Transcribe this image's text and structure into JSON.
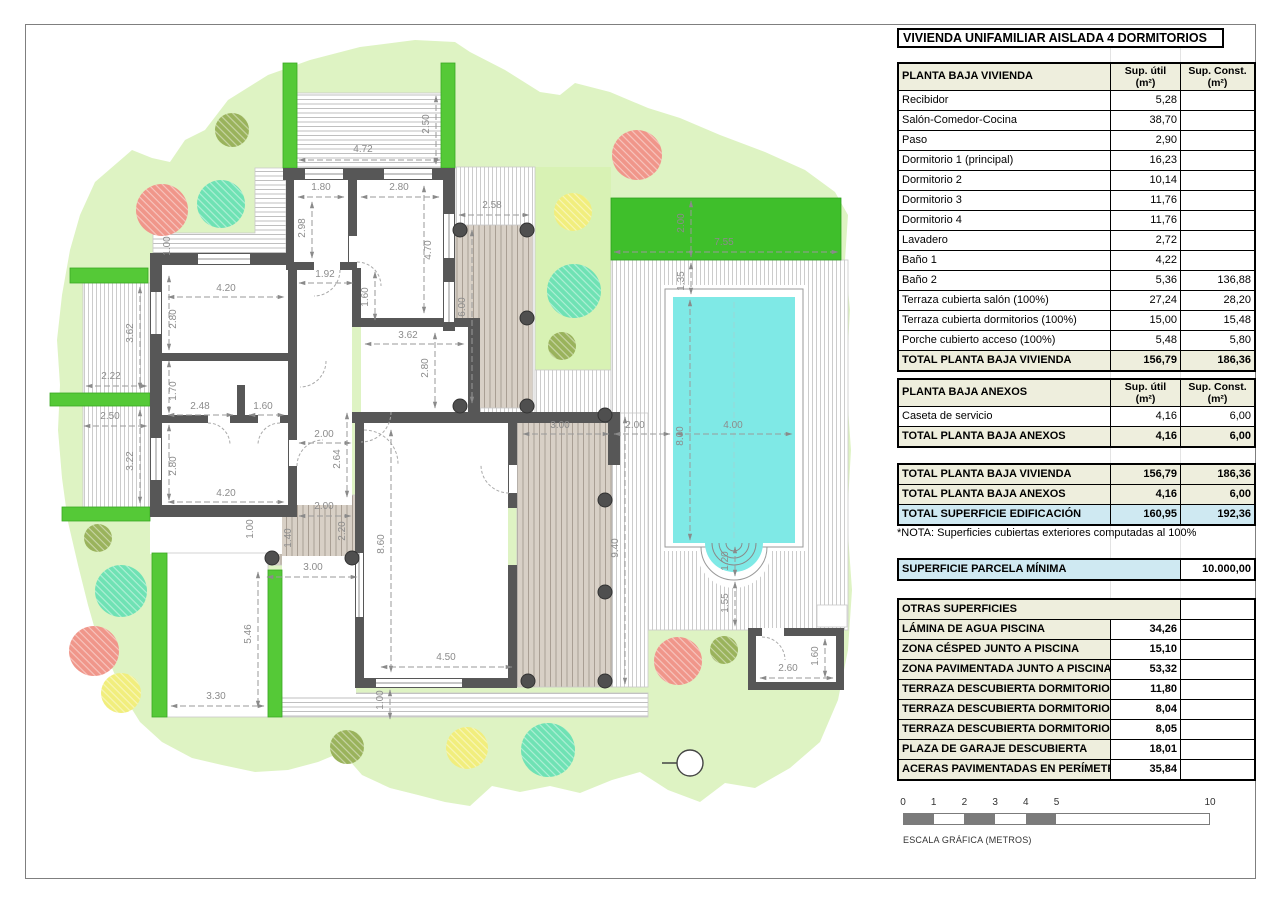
{
  "title": "VIVIENDA UNIFAMILIAR AISLADA 4 DORMITORIOS",
  "tables": {
    "vivienda": {
      "title": "PLANTA BAJA VIVIENDA",
      "col1": "Sup. útil",
      "col2": "Sup. Const.",
      "unit": "(m²)",
      "rows": [
        [
          "Recibidor",
          "5,28",
          ""
        ],
        [
          "Salón-Comedor-Cocina",
          "38,70",
          ""
        ],
        [
          "Paso",
          "2,90",
          ""
        ],
        [
          "Dormitorio 1 (principal)",
          "16,23",
          ""
        ],
        [
          "Dormitorio 2",
          "10,14",
          ""
        ],
        [
          "Dormitorio 3",
          "11,76",
          ""
        ],
        [
          "Dormitorio 4",
          "11,76",
          ""
        ],
        [
          "Lavadero",
          "2,72",
          ""
        ],
        [
          "Baño 1",
          "4,22",
          ""
        ],
        [
          "Baño 2",
          "5,36",
          "136,88"
        ],
        [
          "Terraza cubierta salón (100%)",
          "27,24",
          "28,20"
        ],
        [
          "Terraza cubierta dormitorios (100%)",
          "15,00",
          "15,48"
        ],
        [
          "Porche cubierto acceso (100%)",
          "5,48",
          "5,80"
        ]
      ],
      "total": [
        "TOTAL PLANTA BAJA VIVIENDA",
        "156,79",
        "186,36"
      ]
    },
    "anexos": {
      "title": "PLANTA BAJA ANEXOS",
      "col1": "Sup. útil",
      "col2": "Sup. Const.",
      "unit": "(m²)",
      "rows": [
        [
          "Caseta de servicio",
          "4,16",
          "6,00"
        ]
      ],
      "total": [
        "TOTAL PLANTA BAJA ANEXOS",
        "4,16",
        "6,00"
      ]
    },
    "totales": {
      "rows": [
        [
          "TOTAL PLANTA BAJA VIVIENDA",
          "156,79",
          "186,36",
          false
        ],
        [
          "TOTAL PLANTA BAJA ANEXOS",
          "4,16",
          "6,00",
          false
        ],
        [
          "TOTAL SUPERFICIE EDIFICACIÓN",
          "160,95",
          "192,36",
          true
        ]
      ]
    },
    "parcela": [
      "SUPERFICIE PARCELA MÍNIMA",
      "10.000,00"
    ],
    "otras": {
      "title": "OTRAS SUPERFICIES",
      "rows": [
        [
          "LÁMINA DE AGUA PISCINA",
          "34,26"
        ],
        [
          "ZONA CÉSPED JUNTO A PISCINA",
          "15,10"
        ],
        [
          "ZONA PAVIMENTADA JUNTO A PISCINA",
          "53,32"
        ],
        [
          "TERRAZA DESCUBIERTA DORMITORIO 1",
          "11,80"
        ],
        [
          "TERRAZA DESCUBIERTA DORMITORIO 3",
          "8,04"
        ],
        [
          "TERRAZA DESCUBIERTA DORMITORIO 4",
          "8,05"
        ],
        [
          "PLAZA DE GARAJE DESCUBIERTA",
          "18,01"
        ],
        [
          "ACERAS PAVIMENTADAS EN PERÍMETRO",
          "35,84"
        ]
      ]
    }
  },
  "nota": "*NOTA: Superficies cubiertas exteriores computadas al 100%",
  "scalebar": {
    "ticks": [
      {
        "v": "0",
        "m": 0
      },
      {
        "v": "1",
        "m": 1
      },
      {
        "v": "2",
        "m": 2
      },
      {
        "v": "3",
        "m": 3
      },
      {
        "v": "4",
        "m": 4
      },
      {
        "v": "5",
        "m": 5
      },
      {
        "v": "10",
        "m": 10
      }
    ],
    "segments": [
      [
        0,
        1
      ],
      [
        2,
        3
      ],
      [
        4,
        5
      ]
    ],
    "meters_total": 10,
    "label": "ESCALA GRÁFICA (METROS)"
  },
  "plan": {
    "colors": {
      "garden": "#def3c3",
      "lawn": "#d8f2b4",
      "hedge": "#55c937",
      "cesped": "#3fbf2b",
      "wall": "#575757",
      "water": "#7fe9e6",
      "beige": "#d8d0c6",
      "red": "#f0968a",
      "teal": "#6fe2b4",
      "yellow": "#f1ee7d",
      "olive": "#9ab35c"
    },
    "hedges": [
      [
        283,
        63,
        14,
        105
      ],
      [
        441,
        63,
        14,
        105
      ],
      [
        70,
        268,
        78,
        15
      ],
      [
        50,
        393,
        100,
        13
      ],
      [
        62,
        507,
        88,
        14
      ],
      [
        152,
        553,
        15,
        164
      ],
      [
        268,
        570,
        14,
        147
      ]
    ],
    "columns": [
      [
        460,
        230
      ],
      [
        527,
        230
      ],
      [
        527,
        318
      ],
      [
        460,
        406
      ],
      [
        527,
        406
      ],
      [
        605,
        415
      ],
      [
        605,
        500
      ],
      [
        605,
        592
      ],
      [
        528,
        681
      ],
      [
        605,
        681
      ],
      [
        272,
        558
      ],
      [
        352,
        558
      ]
    ],
    "trees": [
      {
        "x": 232,
        "y": 130,
        "r": 17,
        "c": "olive"
      },
      {
        "x": 162,
        "y": 210,
        "r": 26,
        "c": "red"
      },
      {
        "x": 221,
        "y": 204,
        "r": 24,
        "c": "teal"
      },
      {
        "x": 637,
        "y": 155,
        "r": 25,
        "c": "red"
      },
      {
        "x": 573,
        "y": 212,
        "r": 19,
        "c": "yellow"
      },
      {
        "x": 574,
        "y": 291,
        "r": 27,
        "c": "teal"
      },
      {
        "x": 562,
        "y": 346,
        "r": 14,
        "c": "olive"
      },
      {
        "x": 98,
        "y": 538,
        "r": 14,
        "c": "olive"
      },
      {
        "x": 121,
        "y": 591,
        "r": 26,
        "c": "teal"
      },
      {
        "x": 94,
        "y": 651,
        "r": 25,
        "c": "red"
      },
      {
        "x": 121,
        "y": 693,
        "r": 20,
        "c": "yellow"
      },
      {
        "x": 347,
        "y": 747,
        "r": 17,
        "c": "olive"
      },
      {
        "x": 467,
        "y": 748,
        "r": 21,
        "c": "yellow"
      },
      {
        "x": 548,
        "y": 750,
        "r": 27,
        "c": "teal"
      },
      {
        "x": 678,
        "y": 661,
        "r": 24,
        "c": "red"
      },
      {
        "x": 724,
        "y": 650,
        "r": 14,
        "c": "olive"
      }
    ],
    "dims": [
      {
        "t": "4.72",
        "x": 363,
        "y": 152,
        "r": 0,
        "l": [
          299,
          160,
          440,
          160
        ]
      },
      {
        "t": "2.50",
        "x": 429,
        "y": 124,
        "r": 90,
        "l": [
          436,
          96,
          436,
          164
        ]
      },
      {
        "t": "1.80",
        "x": 321,
        "y": 190,
        "r": 0,
        "l": [
          298,
          197,
          344,
          197
        ]
      },
      {
        "t": "2.80",
        "x": 399,
        "y": 190,
        "r": 0,
        "l": [
          361,
          197,
          439,
          197
        ]
      },
      {
        "t": "2.98",
        "x": 305,
        "y": 228,
        "r": 90,
        "l": [
          312,
          202,
          312,
          258
        ]
      },
      {
        "t": "4.70",
        "x": 431,
        "y": 250,
        "r": 90,
        "l": [
          424,
          186,
          424,
          313
        ]
      },
      {
        "t": "2.58",
        "x": 492,
        "y": 208,
        "r": 0,
        "l": [
          459,
          215,
          529,
          215
        ]
      },
      {
        "t": "1.92",
        "x": 325,
        "y": 277,
        "r": 0,
        "l": [
          299,
          283,
          353,
          283
        ]
      },
      {
        "t": "1.60",
        "x": 368,
        "y": 297,
        "r": 90,
        "l": [
          375,
          272,
          375,
          320
        ]
      },
      {
        "t": "4.20",
        "x": 226,
        "y": 291,
        "r": 0,
        "l": [
          168,
          297,
          284,
          297
        ]
      },
      {
        "t": "2.80",
        "x": 176,
        "y": 319,
        "r": 90,
        "l": [
          169,
          276,
          169,
          350
        ]
      },
      {
        "t": "3.62",
        "x": 408,
        "y": 338,
        "r": 0,
        "l": [
          365,
          344,
          464,
          344
        ]
      },
      {
        "t": "2.80",
        "x": 428,
        "y": 368,
        "r": 90,
        "l": [
          435,
          333,
          435,
          408
        ]
      },
      {
        "t": "3.62",
        "x": 133,
        "y": 333,
        "r": 90,
        "l": [
          140,
          287,
          140,
          389
        ]
      },
      {
        "t": "2.22",
        "x": 111,
        "y": 379,
        "r": 0,
        "l": [
          86,
          386,
          147,
          386
        ]
      },
      {
        "t": "2.50",
        "x": 110,
        "y": 419,
        "r": 0,
        "l": [
          84,
          426,
          147,
          426
        ]
      },
      {
        "t": "3.22",
        "x": 133,
        "y": 461,
        "r": 90,
        "l": [
          140,
          410,
          140,
          503
        ]
      },
      {
        "t": "1.70",
        "x": 176,
        "y": 391,
        "r": 90,
        "l": [
          169,
          361,
          169,
          413
        ]
      },
      {
        "t": "2.48",
        "x": 200,
        "y": 409,
        "r": 0,
        "l": [
          168,
          415,
          233,
          415
        ]
      },
      {
        "t": "1.60",
        "x": 263,
        "y": 409,
        "r": 0,
        "l": [
          249,
          415,
          284,
          415
        ]
      },
      {
        "t": "2.80",
        "x": 176,
        "y": 466,
        "r": 90,
        "l": [
          169,
          425,
          169,
          500
        ]
      },
      {
        "t": "4.20",
        "x": 226,
        "y": 496,
        "r": 0,
        "l": [
          168,
          502,
          284,
          502
        ]
      },
      {
        "t": "2.00",
        "x": 324,
        "y": 437,
        "r": 0,
        "l": [
          299,
          443,
          351,
          443
        ]
      },
      {
        "t": "2.64",
        "x": 340,
        "y": 459,
        "r": 90,
        "l": [
          347,
          413,
          347,
          497
        ]
      },
      {
        "t": "2.00",
        "x": 324,
        "y": 509,
        "r": 0,
        "l": [
          299,
          516,
          351,
          516
        ]
      },
      {
        "t": "2.20",
        "x": 345,
        "y": 531,
        "r": 90
      },
      {
        "t": "1.40",
        "x": 291,
        "y": 538,
        "r": 90
      },
      {
        "t": "3.00",
        "x": 313,
        "y": 570,
        "r": 0,
        "l": [
          267,
          577,
          357,
          577
        ]
      },
      {
        "t": "8.60",
        "x": 384,
        "y": 544,
        "r": 90,
        "l": [
          391,
          430,
          391,
          672
        ]
      },
      {
        "t": "1.00",
        "x": 170,
        "y": 246,
        "r": 90
      },
      {
        "t": "1.00",
        "x": 253,
        "y": 529,
        "r": 90
      },
      {
        "t": "5.46",
        "x": 251,
        "y": 634,
        "r": 90,
        "l": [
          258,
          572,
          258,
          707
        ]
      },
      {
        "t": "3.30",
        "x": 216,
        "y": 699,
        "r": 0,
        "l": [
          171,
          706,
          264,
          706
        ]
      },
      {
        "t": "1.00",
        "x": 383,
        "y": 700,
        "r": 90,
        "l": [
          390,
          690,
          390,
          719
        ]
      },
      {
        "t": "4.50",
        "x": 446,
        "y": 660,
        "r": 0,
        "l": [
          381,
          667,
          512,
          667
        ]
      },
      {
        "t": "6.00",
        "x": 465,
        "y": 307,
        "r": 90,
        "l": [
          472,
          230,
          472,
          403
        ]
      },
      {
        "t": "2.00",
        "x": 684,
        "y": 223,
        "r": 90,
        "l": [
          691,
          201,
          691,
          257
        ]
      },
      {
        "t": "7.55",
        "x": 724,
        "y": 245,
        "r": 0,
        "l": [
          614,
          252,
          838,
          252
        ]
      },
      {
        "t": "1.35",
        "x": 684,
        "y": 281,
        "r": 90,
        "l": [
          691,
          263,
          691,
          294
        ]
      },
      {
        "t": "3.00",
        "x": 560,
        "y": 428,
        "r": 0,
        "l": [
          523,
          434,
          609,
          434
        ]
      },
      {
        "t": "2.00",
        "x": 635,
        "y": 428,
        "r": 0,
        "l": [
          614,
          434,
          670,
          434
        ]
      },
      {
        "t": "4.00",
        "x": 733,
        "y": 428,
        "r": 0,
        "l": [
          676,
          434,
          792,
          434
        ]
      },
      {
        "t": "8.00",
        "x": 683,
        "y": 436,
        "r": 90,
        "l": [
          690,
          300,
          690,
          540
        ]
      },
      {
        "t": "9.40",
        "x": 618,
        "y": 548,
        "r": 90,
        "l": [
          625,
          417,
          625,
          684
        ]
      },
      {
        "t": "1.20",
        "x": 728,
        "y": 561,
        "r": 90,
        "l": [
          735,
          547,
          735,
          576
        ]
      },
      {
        "t": "1.55",
        "x": 728,
        "y": 603,
        "r": 90,
        "l": [
          735,
          582,
          735,
          626
        ]
      },
      {
        "t": "2.60",
        "x": 788,
        "y": 671,
        "r": 0,
        "l": [
          760,
          678,
          833,
          678
        ]
      },
      {
        "t": "1.60",
        "x": 818,
        "y": 656,
        "r": 90,
        "l": [
          825,
          639,
          825,
          677
        ]
      }
    ]
  }
}
